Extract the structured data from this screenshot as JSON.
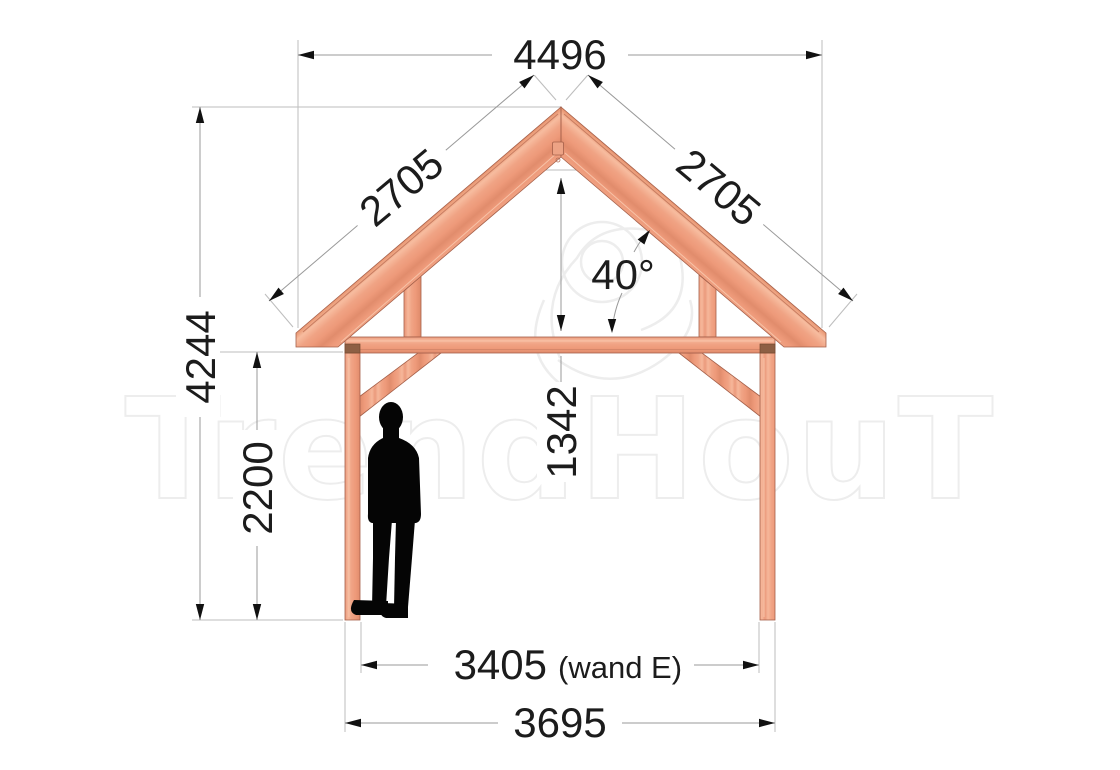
{
  "watermark": {
    "text": "TrendHouT"
  },
  "dimensions": {
    "top_width": "4496",
    "rafter_left": "2705",
    "rafter_right": "2705",
    "roof_angle": "40°",
    "total_height": "4244",
    "wall_height": "2200",
    "truss_rise": "1342",
    "inner_width": "3405",
    "inner_width_note": "(wand E)",
    "outer_width": "3695"
  },
  "colors": {
    "wood": "#f0a384",
    "wood_outline": "#a5604a",
    "joint_block": "#8d5f44",
    "dimension_line": "#999999",
    "extension_line": "#bdbdbd",
    "dimension_text": "#1c1c1c",
    "watermark": "#ededed",
    "silhouette": "#050505",
    "background": "#ffffff"
  }
}
